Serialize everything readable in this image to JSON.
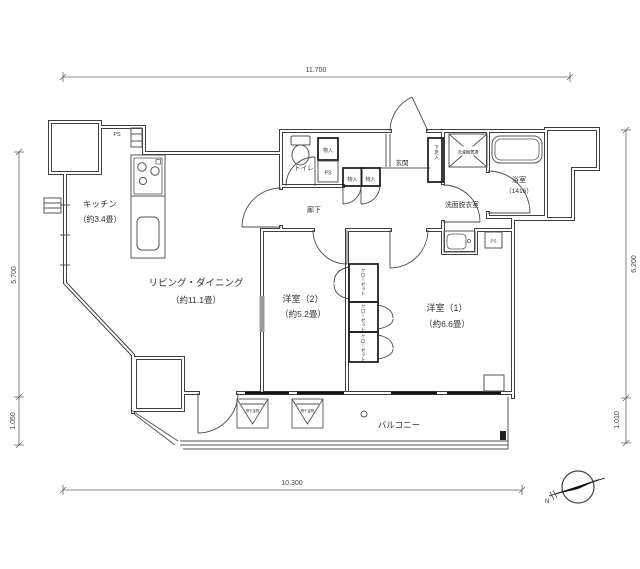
{
  "floorplan": {
    "dimensions": {
      "top": "11.700",
      "bottom": "10.300",
      "left_main": "5.700",
      "left_sub": "1.050",
      "right_main": "6.200",
      "right_sub": "1.010"
    },
    "rooms": {
      "kitchen_name": "キッチン",
      "kitchen_size": "（約3.4畳）",
      "living_name": "リビング・ダイニング",
      "living_size": "（約11.1畳）",
      "bedroom2_name": "洋室（2）",
      "bedroom2_size": "（約5.2畳）",
      "bedroom1_name": "洋室（1）",
      "bedroom1_size": "（約6.6畳）",
      "hallway": "廊下",
      "toilet": "トイレ",
      "entrance": "玄関",
      "washroom": "洗面脱衣室",
      "bathroom_name": "浴室",
      "bathroom_size": "（1416）",
      "balcony": "バルコニー"
    },
    "fixtures": {
      "shoe_cabinet": "下足入",
      "closet": "クローゼット",
      "storage": "物入",
      "pipe_space": "PS",
      "washer": "洗濯機置場",
      "laundry_bracket": "物干金物"
    },
    "compass_north": "N",
    "colors": {
      "line": "#3f3f3f",
      "text": "#333333",
      "background": "#ffffff"
    }
  }
}
